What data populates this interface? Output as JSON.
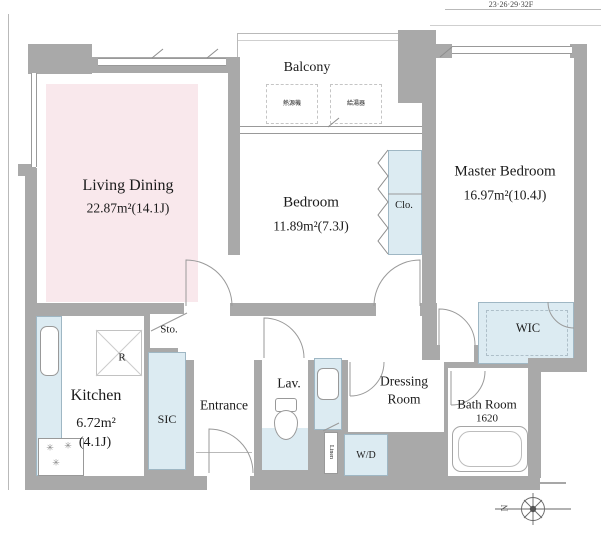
{
  "header": {
    "floors_note": "23·26·29·32F"
  },
  "balcony": {
    "label": "Balcony",
    "unit1": "熱源機",
    "unit2": "給湯器"
  },
  "living": {
    "name": "Living Dining",
    "area": "22.87m²(14.1J)"
  },
  "bedroom": {
    "name": "Bedroom",
    "area": "11.89m²(7.3J)"
  },
  "master": {
    "name": "Master Bedroom",
    "area": "16.97m²(10.4J)"
  },
  "closet": {
    "label": "Clo."
  },
  "wic": {
    "label": "WIC"
  },
  "kitchen": {
    "name": "Kitchen",
    "area1": "6.72m²",
    "area2": "(4.1J)"
  },
  "refrigerator": {
    "label": "R"
  },
  "storage": {
    "label": "Sto."
  },
  "sic": {
    "label": "SIC"
  },
  "entrance": {
    "label": "Entrance"
  },
  "lavatory": {
    "label": "Lav."
  },
  "dressing": {
    "line1": "Dressing",
    "line2": "Room"
  },
  "bath": {
    "name": "Bath Room",
    "size": "1620"
  },
  "washer": {
    "label": "W/D"
  },
  "linen": {
    "label": "Linen"
  },
  "compass": {
    "label": "N"
  },
  "colors": {
    "wall": "#a9a9a9",
    "fixture_blue": "#dcebf2",
    "living_pink": "#f9e8ec"
  }
}
